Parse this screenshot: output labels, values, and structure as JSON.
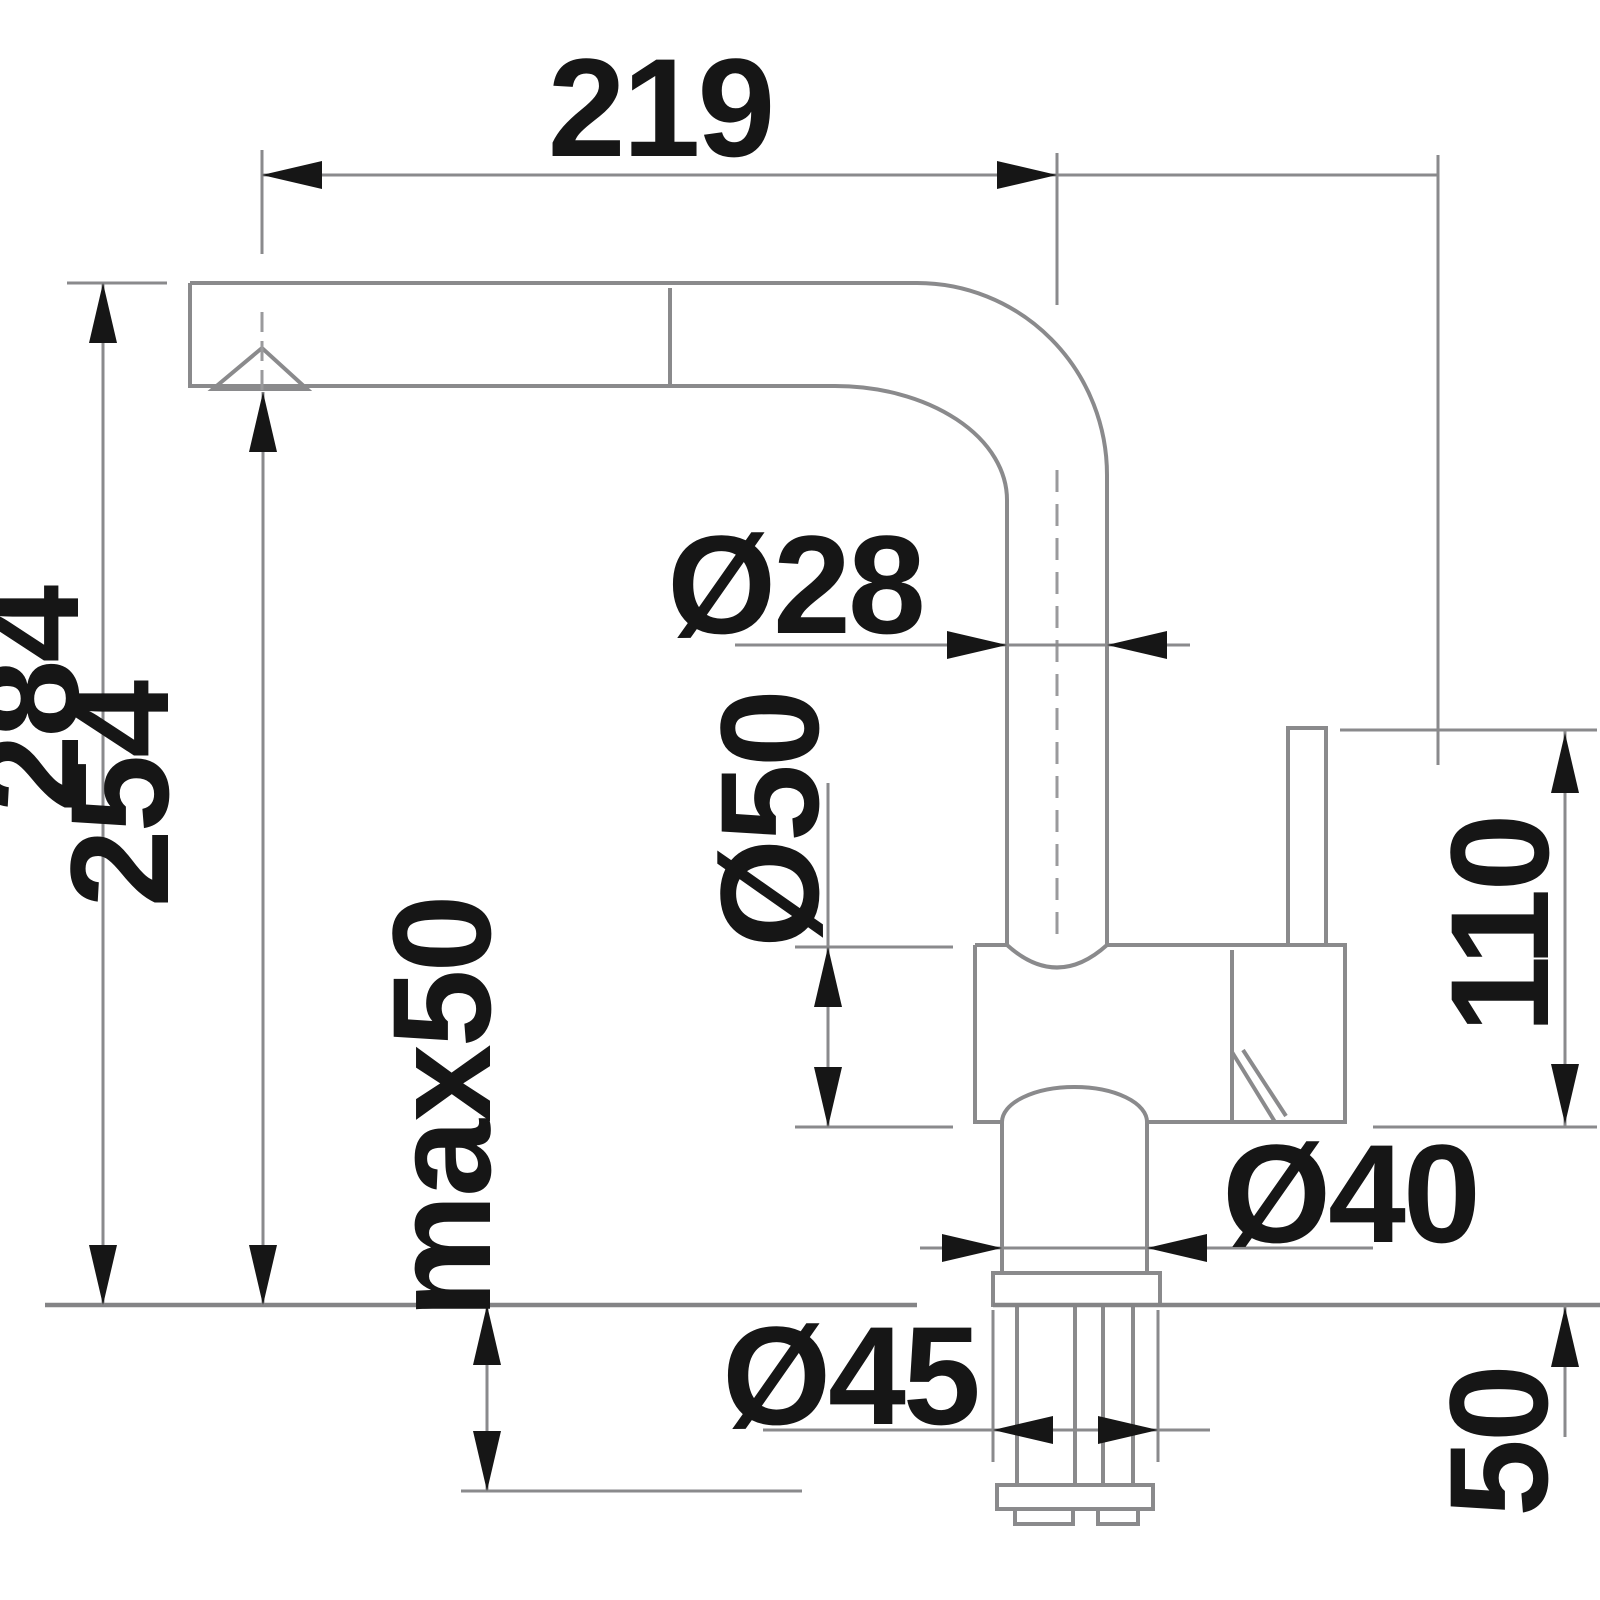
{
  "drawing": {
    "type": "technical-dimension-drawing",
    "subject": "kitchen-faucet-side-view",
    "units": "mm",
    "labels": {
      "spout_reach": "219",
      "total_height": "284",
      "spout_height": "254",
      "max_mounting_thickness": "max50",
      "pipe_diameter": "Ø28",
      "body_diameter": "Ø50",
      "neck_diameter": "Ø40",
      "base_diameter": "Ø45",
      "handle_height": "110",
      "under_counter_length": "50"
    },
    "colors": {
      "background": "#ffffff",
      "outline_gray": "#8a8a8c",
      "text_and_arrows": "#161616"
    }
  }
}
